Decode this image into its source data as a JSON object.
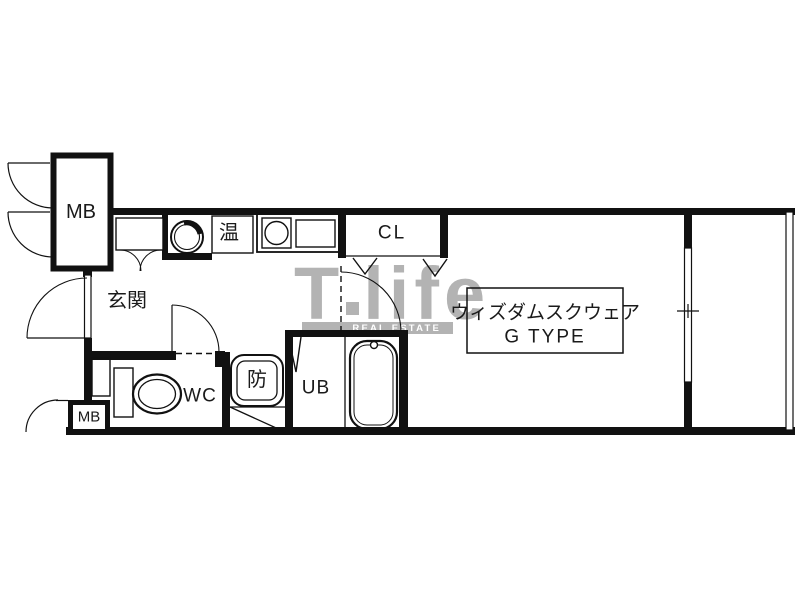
{
  "plan": {
    "title_line1": "ウィズダムスクウェア",
    "title_line2": "G TYPE"
  },
  "labels": {
    "meter_box_top": "MB",
    "meter_box_bottom": "MB",
    "entrance": "玄関",
    "water_heater": "温",
    "closet": "CL",
    "toilet_room": "WC",
    "waterproof_pan": "防",
    "unit_bath": "UB"
  },
  "watermark": {
    "brand_t": "T",
    "brand_life": "life",
    "subtitle": "REAL ESTATE"
  },
  "colors": {
    "line": "#111111",
    "watermark_gray": "#b3b3b3",
    "background": "#ffffff"
  }
}
